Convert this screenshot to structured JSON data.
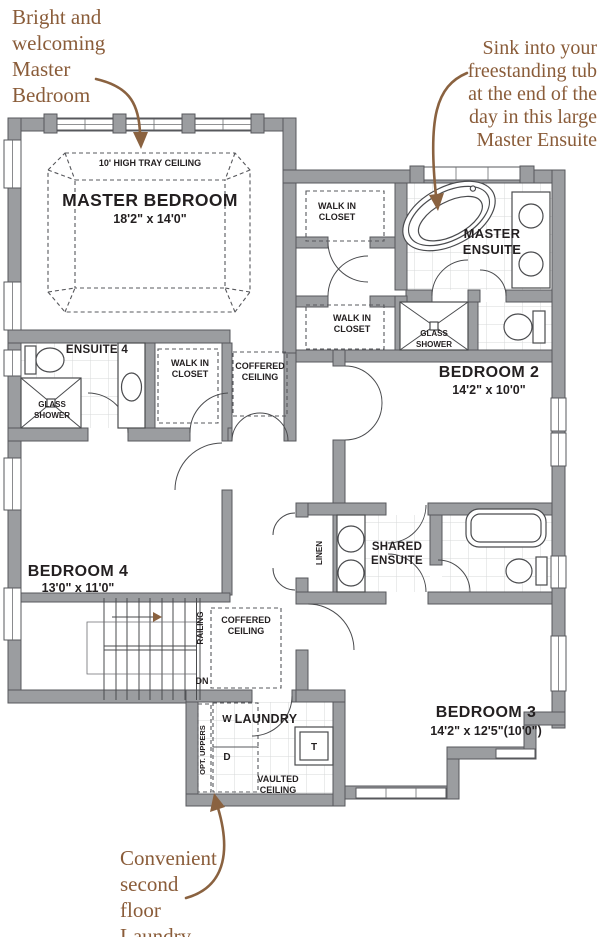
{
  "annotations": {
    "master_bedroom_note": {
      "lines": [
        "Bright and",
        "welcoming",
        "Master",
        "Bedroom"
      ]
    },
    "master_ensuite_note": {
      "lines": [
        "Sink into your",
        "freestanding tub",
        "at the end of the",
        "day in this large",
        "Master Ensuite"
      ]
    },
    "laundry_note": {
      "lines": [
        "Convenient",
        "second",
        "floor",
        "Laundry"
      ]
    }
  },
  "rooms": {
    "master_bedroom": {
      "name": "MASTER BEDROOM",
      "dims": "18'2\" x 14'0\"",
      "ceiling_note": "10' HIGH TRAY CEILING"
    },
    "master_ensuite": {
      "name_line1": "MASTER",
      "name_line2": "ENSUITE"
    },
    "bedroom_2": {
      "name": "BEDROOM 2",
      "dims": "14'2\" x 10'0\""
    },
    "bedroom_3": {
      "name": "BEDROOM 3",
      "dims": "14'2\" x 12'5\"(10'0\")"
    },
    "bedroom_4": {
      "name": "BEDROOM 4",
      "dims": "13'0\" x 11'0\""
    },
    "ensuite_4": {
      "name": "ENSUITE 4"
    },
    "shared_ensuite": {
      "name_line1": "SHARED",
      "name_line2": "ENSUITE"
    },
    "laundry": {
      "name": "LAUNDRY"
    }
  },
  "labels": {
    "walk_in_line1": "WALK IN",
    "walk_in_line2": "CLOSET",
    "glass_line1": "GLASS",
    "glass_line2": "SHOWER",
    "coffered_line1": "COFFERED",
    "coffered_line2": "CEILING",
    "vaulted_line1": "VAULTED",
    "vaulted_line2": "CEILING",
    "linen": "LINEN",
    "railing": "RAILING",
    "down": "DN",
    "washer": "W",
    "dryer": "D",
    "laundry_tub": "T",
    "opt_uppers": "OPT. UPPERS"
  },
  "colors": {
    "wall": "#9b9da0",
    "line": "#4a4b4e",
    "tile": "#d7d8da",
    "text": "#231f20",
    "annotation": "#8a5c39",
    "arrow": "#8a6240"
  }
}
